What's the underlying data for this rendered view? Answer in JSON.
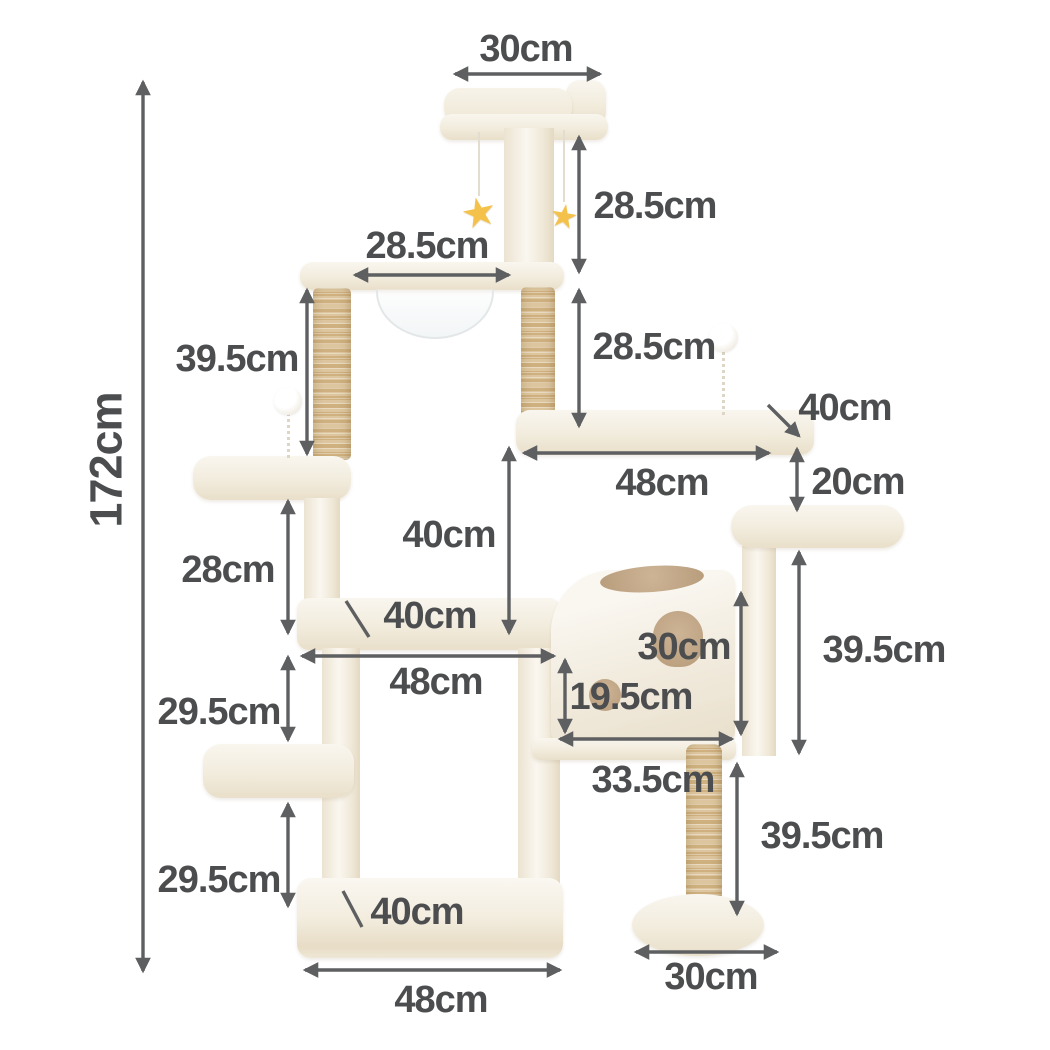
{
  "title": "Cat tree dimension diagram",
  "unit": "cm",
  "colors": {
    "background": "#ffffff",
    "label_text": "#4b4d4f",
    "arrow": "#5d5f61",
    "fabric_light": "#f9f6ef",
    "fabric_shadow": "#e9dfca",
    "sisal_light": "#ddc69f",
    "sisal_dark": "#cfb07f",
    "hole_tan": "#b89d7c",
    "star_yellow": "#f4c24b"
  },
  "icons": {
    "star_toy": "star-icon",
    "pompom_toy": "pompom-icon"
  },
  "dimensions": {
    "total_height": "172cm",
    "top_perch_width": "30cm",
    "top_tier_height": "28.5cm",
    "bowl_platform_width": "28.5cm",
    "upper_post_height": "39.5cm",
    "second_tier_height": "28.5cm",
    "right_platform_depth": "40cm",
    "right_platform_width": "48cm",
    "step_drop": "20cm",
    "left_perch_drop": "28cm",
    "middle_tier_height": "40cm",
    "middle_platform_depth": "40cm",
    "middle_platform_width": "48cm",
    "condo_height": "30cm",
    "condo_door_height": "19.5cm",
    "condo_width": "33.5cm",
    "condo_outer_height": "39.5cm",
    "upper_ledge_drop": "29.5cm",
    "lower_ledge_drop": "29.5cm",
    "pedestal_post_height": "39.5cm",
    "base_width": "48cm",
    "pedestal_base_diameter": "30cm",
    "base_depth": "40cm"
  }
}
